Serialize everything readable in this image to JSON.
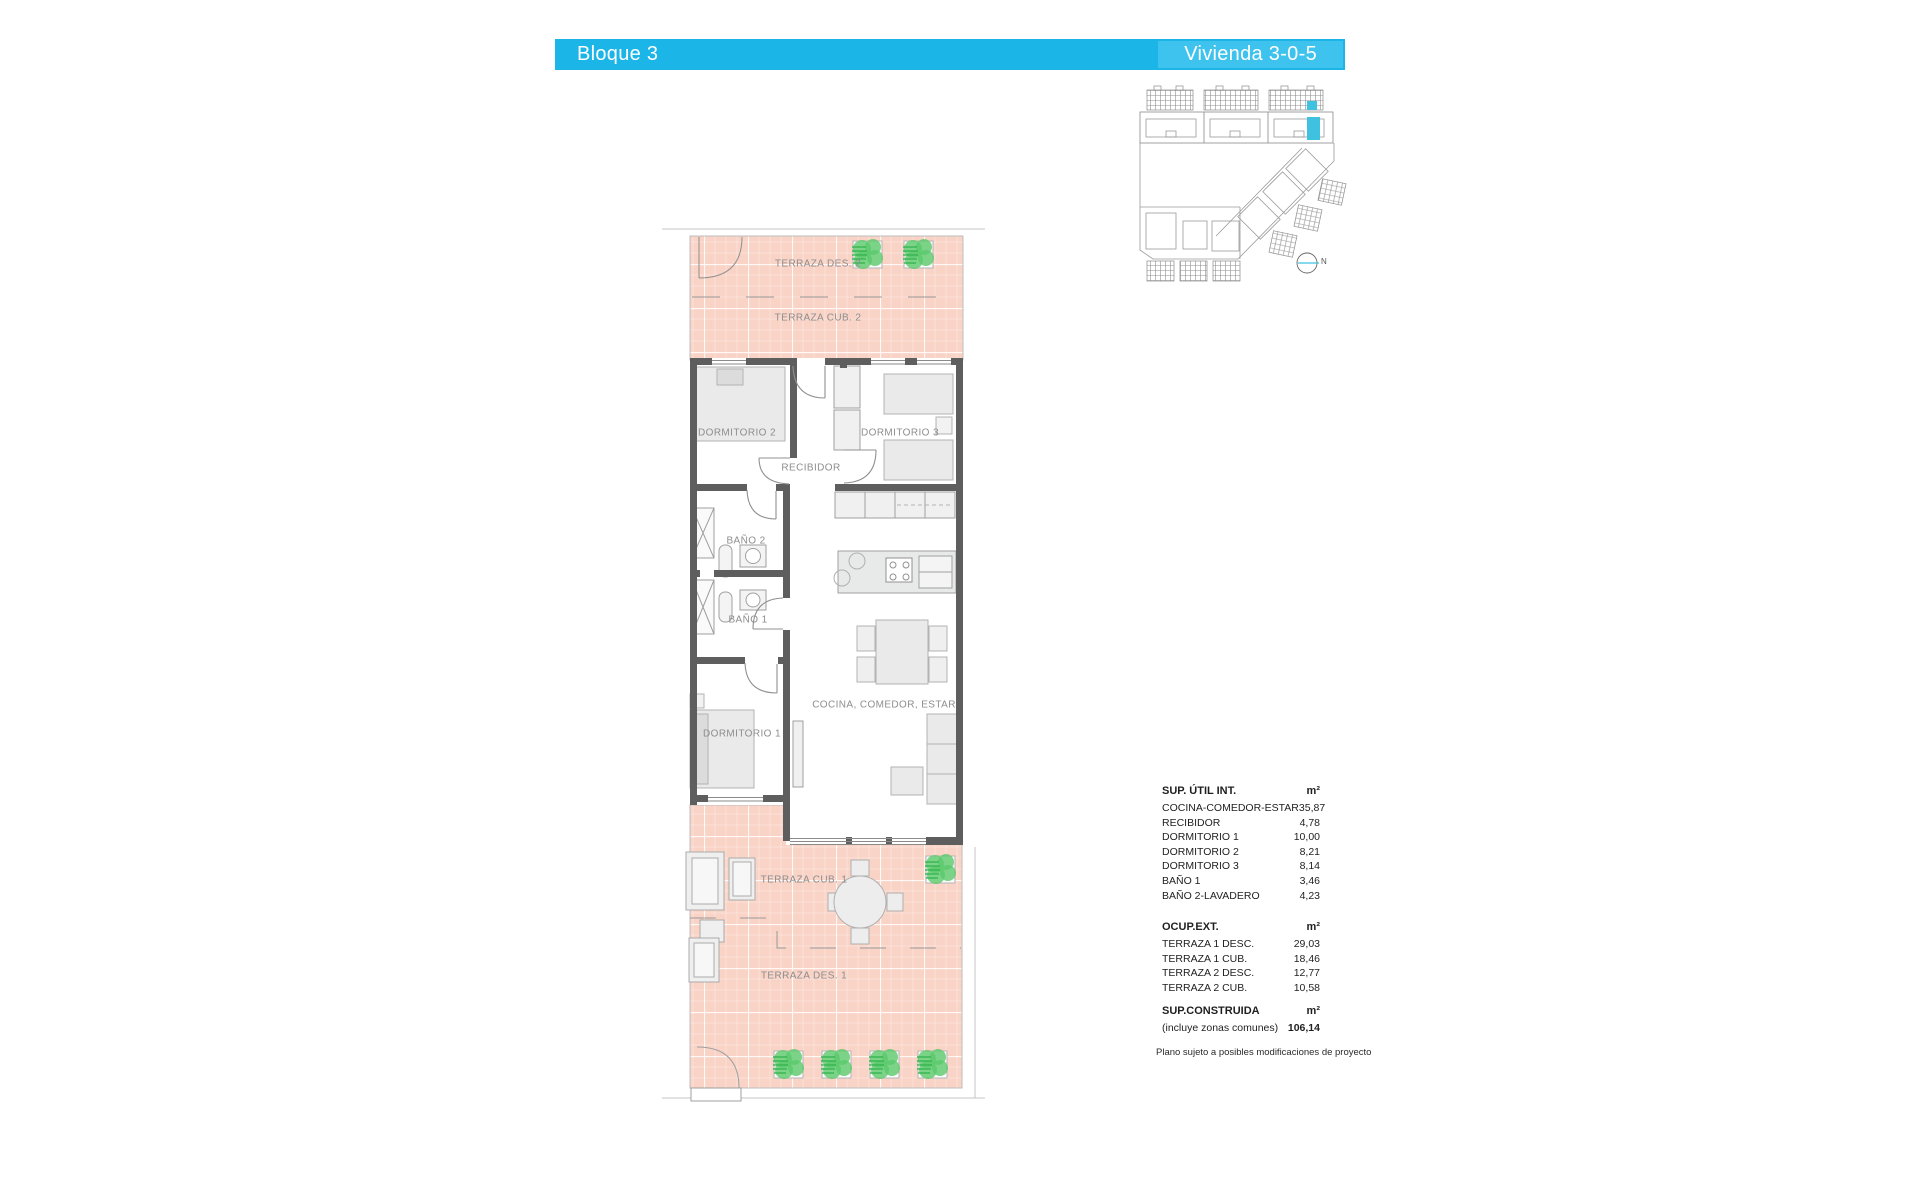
{
  "header": {
    "block_label": "Bloque 3",
    "unit_label": "Vivienda 3-0-5"
  },
  "colors": {
    "header_bar": "#1BB5E8",
    "header_highlight": "#3EC2EE",
    "terrace_pink": "#F9D3C6",
    "wall_gray": "#5E5E5E",
    "plant_green": "#5BC96C",
    "site_unit_highlight": "#3FC1E0"
  },
  "floorplan": {
    "labels": {
      "terraza_des_2": "TERRAZA DES. 2",
      "terraza_cub_2": "TERRAZA CUB. 2",
      "dormitorio_2": "DORMITORIO 2",
      "dormitorio_3": "DORMITORIO 3",
      "recibidor": "RECIBIDOR",
      "bano_2": "BAÑO 2",
      "bano_1": "BAÑO 1",
      "dormitorio_1": "DORMITORIO 1",
      "cocina": "COCINA, COMEDOR, ESTAR",
      "terraza_cub_1": "TERRAZA CUB. 1",
      "terraza_des_1": "TERRAZA DES. 1"
    }
  },
  "site_plan": {
    "north_label": "N"
  },
  "tables": {
    "sup_util": {
      "title": "SUP. ÚTIL INT.",
      "unit": "m²",
      "rows": [
        {
          "label": "COCINA-COMEDOR-ESTAR",
          "value": "35,87"
        },
        {
          "label": "RECIBIDOR",
          "value": "4,78"
        },
        {
          "label": "DORMITORIO 1",
          "value": "10,00"
        },
        {
          "label": "DORMITORIO 2",
          "value": "8,21"
        },
        {
          "label": "DORMITORIO 3",
          "value": "8,14"
        },
        {
          "label": "BAÑO 1",
          "value": "3,46"
        },
        {
          "label": "BAÑO 2-LAVADERO",
          "value": "4,23"
        }
      ]
    },
    "ocup_ext": {
      "title": "OCUP.EXT.",
      "unit": "m²",
      "rows": [
        {
          "label": "TERRAZA 1 DESC.",
          "value": "29,03"
        },
        {
          "label": "TERRAZA 1 CUB.",
          "value": "18,46"
        },
        {
          "label": "TERRAZA 2 DESC.",
          "value": "12,77"
        },
        {
          "label": "TERRAZA 2 CUB.",
          "value": "10,58"
        }
      ]
    },
    "sup_construida": {
      "title": "SUP.CONSTRUIDA",
      "unit": "m²",
      "note": "(incluye zonas comunes)",
      "value": "106,14"
    },
    "disclaimer": "Plano sujeto a posibles modificaciones de proyecto"
  }
}
